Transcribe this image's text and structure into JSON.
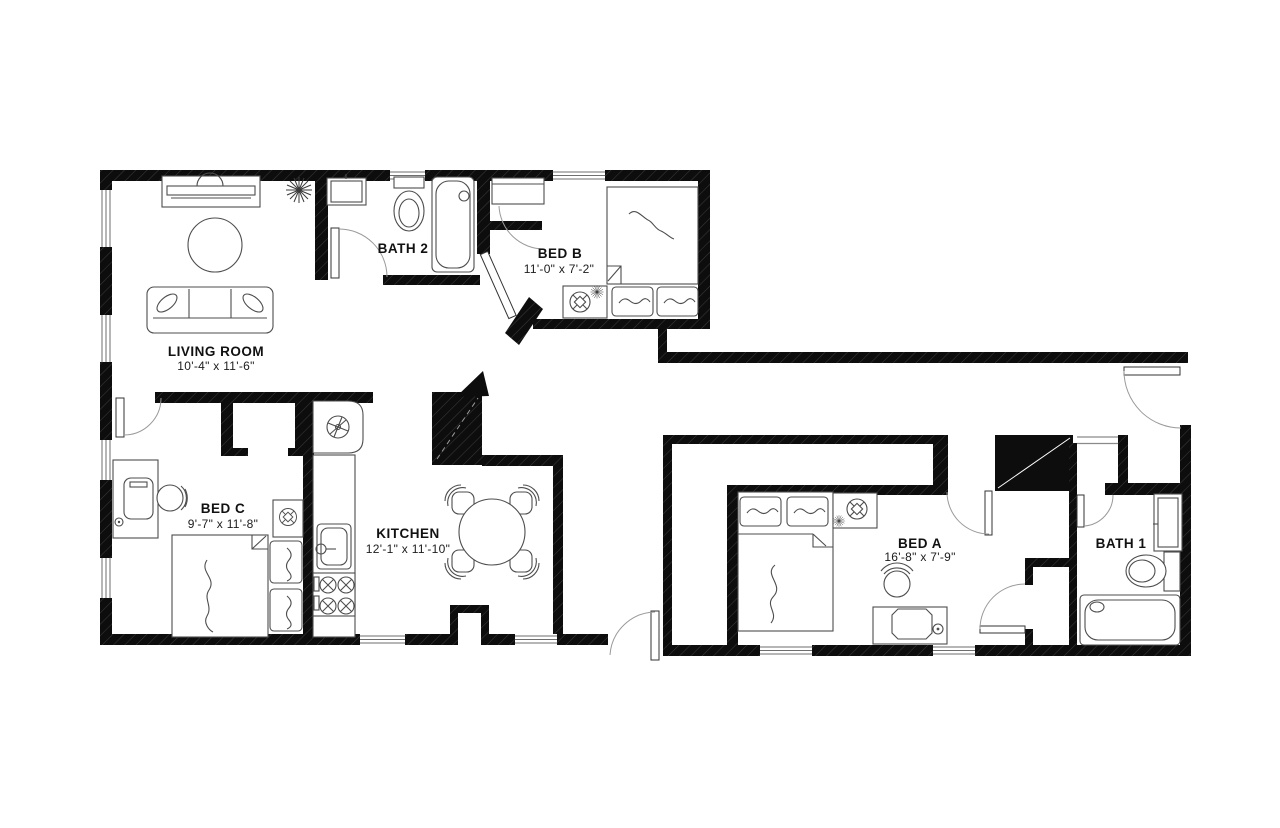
{
  "plan": {
    "rooms": [
      {
        "id": "living-room",
        "label": "LIVING ROOM",
        "dimensions": "10'-4\" x 11'-6\""
      },
      {
        "id": "bath-2",
        "label": "BATH 2"
      },
      {
        "id": "bed-b",
        "label": "BED B",
        "dimensions": "11'-0\" x 7'-2\""
      },
      {
        "id": "bed-c",
        "label": "BED C",
        "dimensions": "9'-7\" x 11'-8\""
      },
      {
        "id": "kitchen",
        "label": "KITCHEN",
        "dimensions": "12'-1\" x 11'-10\""
      },
      {
        "id": "bed-a",
        "label": "BED A",
        "dimensions": "16'-8\" x 7'-9\""
      },
      {
        "id": "bath-1",
        "label": "BATH 1"
      }
    ],
    "colors": {
      "wall": "#0d0d0d",
      "furniture_line": "#4d4d4d",
      "background": "#ffffff"
    }
  }
}
